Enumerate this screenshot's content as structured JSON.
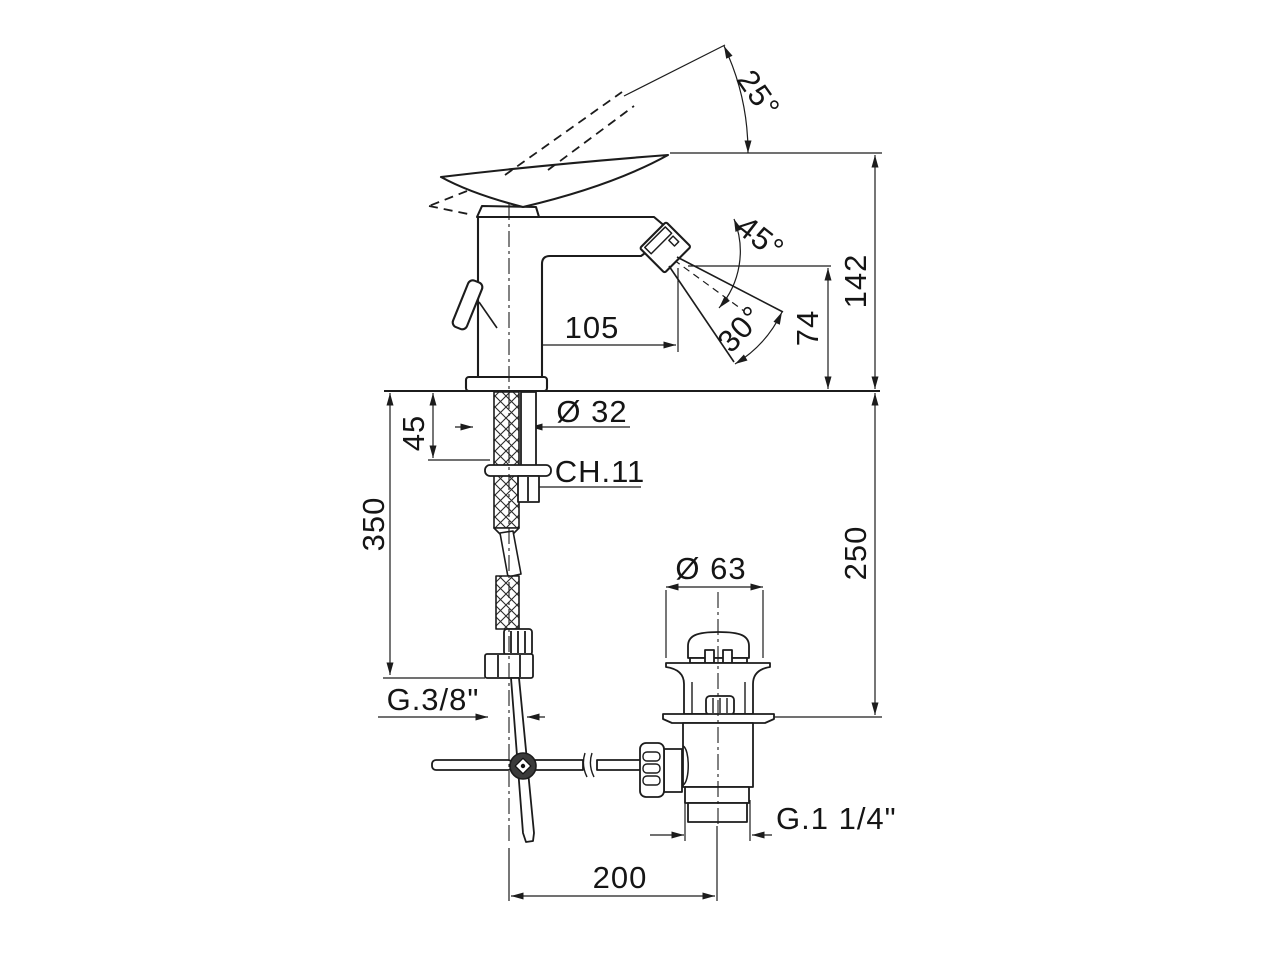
{
  "drawing": {
    "type": "technical dimension drawing",
    "subject": "single-lever bidet mixer with swivel spray aerator and pop-up waste, side elevation",
    "labels": {
      "angle_handle": "25°",
      "angle_spout": "45°",
      "angle_spray": "30°",
      "height_total": "142",
      "height_spout": "74",
      "reach": "105",
      "base_dia": "Ø 32",
      "shank_len": "45",
      "wrench": "CH.11",
      "hose_len": "350",
      "waste_height": "250",
      "waste_cap_dia": "Ø 63",
      "hose_thread": "G.3/8\"",
      "waste_thread": "G.1 1/4\"",
      "rod_offset": "200"
    }
  }
}
